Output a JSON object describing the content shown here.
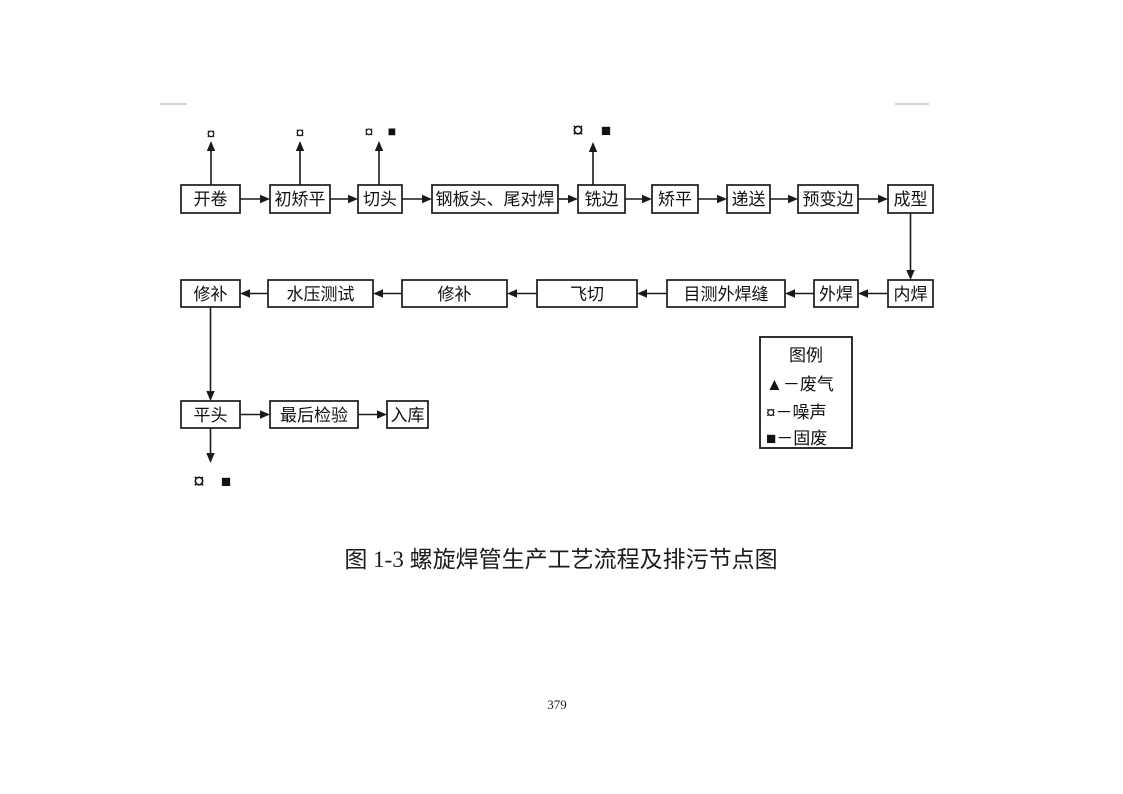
{
  "document": {
    "caption": "图 1-3  螺旋焊管生产工艺流程及排污节点图",
    "page_number": "379"
  },
  "flowchart": {
    "row1": [
      "开卷",
      "初矫平",
      "切头",
      "钢板头、尾对焊",
      "铣边",
      "矫平",
      "递送",
      "预变边",
      "成型"
    ],
    "row2": [
      "修补",
      "水压测试",
      "修补",
      "飞切",
      "目测外焊缝",
      "外焊",
      "内焊"
    ],
    "row3": [
      "平头",
      "最后检验",
      "入库"
    ],
    "emissions": {
      "noise_symbol": "¤",
      "solid_waste_symbol": "■",
      "exhaust_symbol": "▲",
      "markers": [
        {
          "node": "开卷",
          "symbols": "噪声"
        },
        {
          "node": "初矫平",
          "symbols": "噪声"
        },
        {
          "node": "切头",
          "symbols": "噪声、固废"
        },
        {
          "node": "铣边",
          "symbols": "噪声、固废"
        },
        {
          "node": "平头",
          "symbols": "噪声、固废"
        }
      ]
    }
  },
  "legend": {
    "title": "图例",
    "items": [
      {
        "symbol": "▲",
        "meaning": "废气",
        "text": "▲－废气"
      },
      {
        "symbol": "¤",
        "meaning": "噪声",
        "text": "¤－噪声"
      },
      {
        "symbol": "■",
        "meaning": "固废",
        "text": "■－固废"
      }
    ]
  },
  "colors": {
    "ink": "#1a1a1a",
    "background": "#ffffff",
    "scan_artifact": "#c6c6c6"
  }
}
